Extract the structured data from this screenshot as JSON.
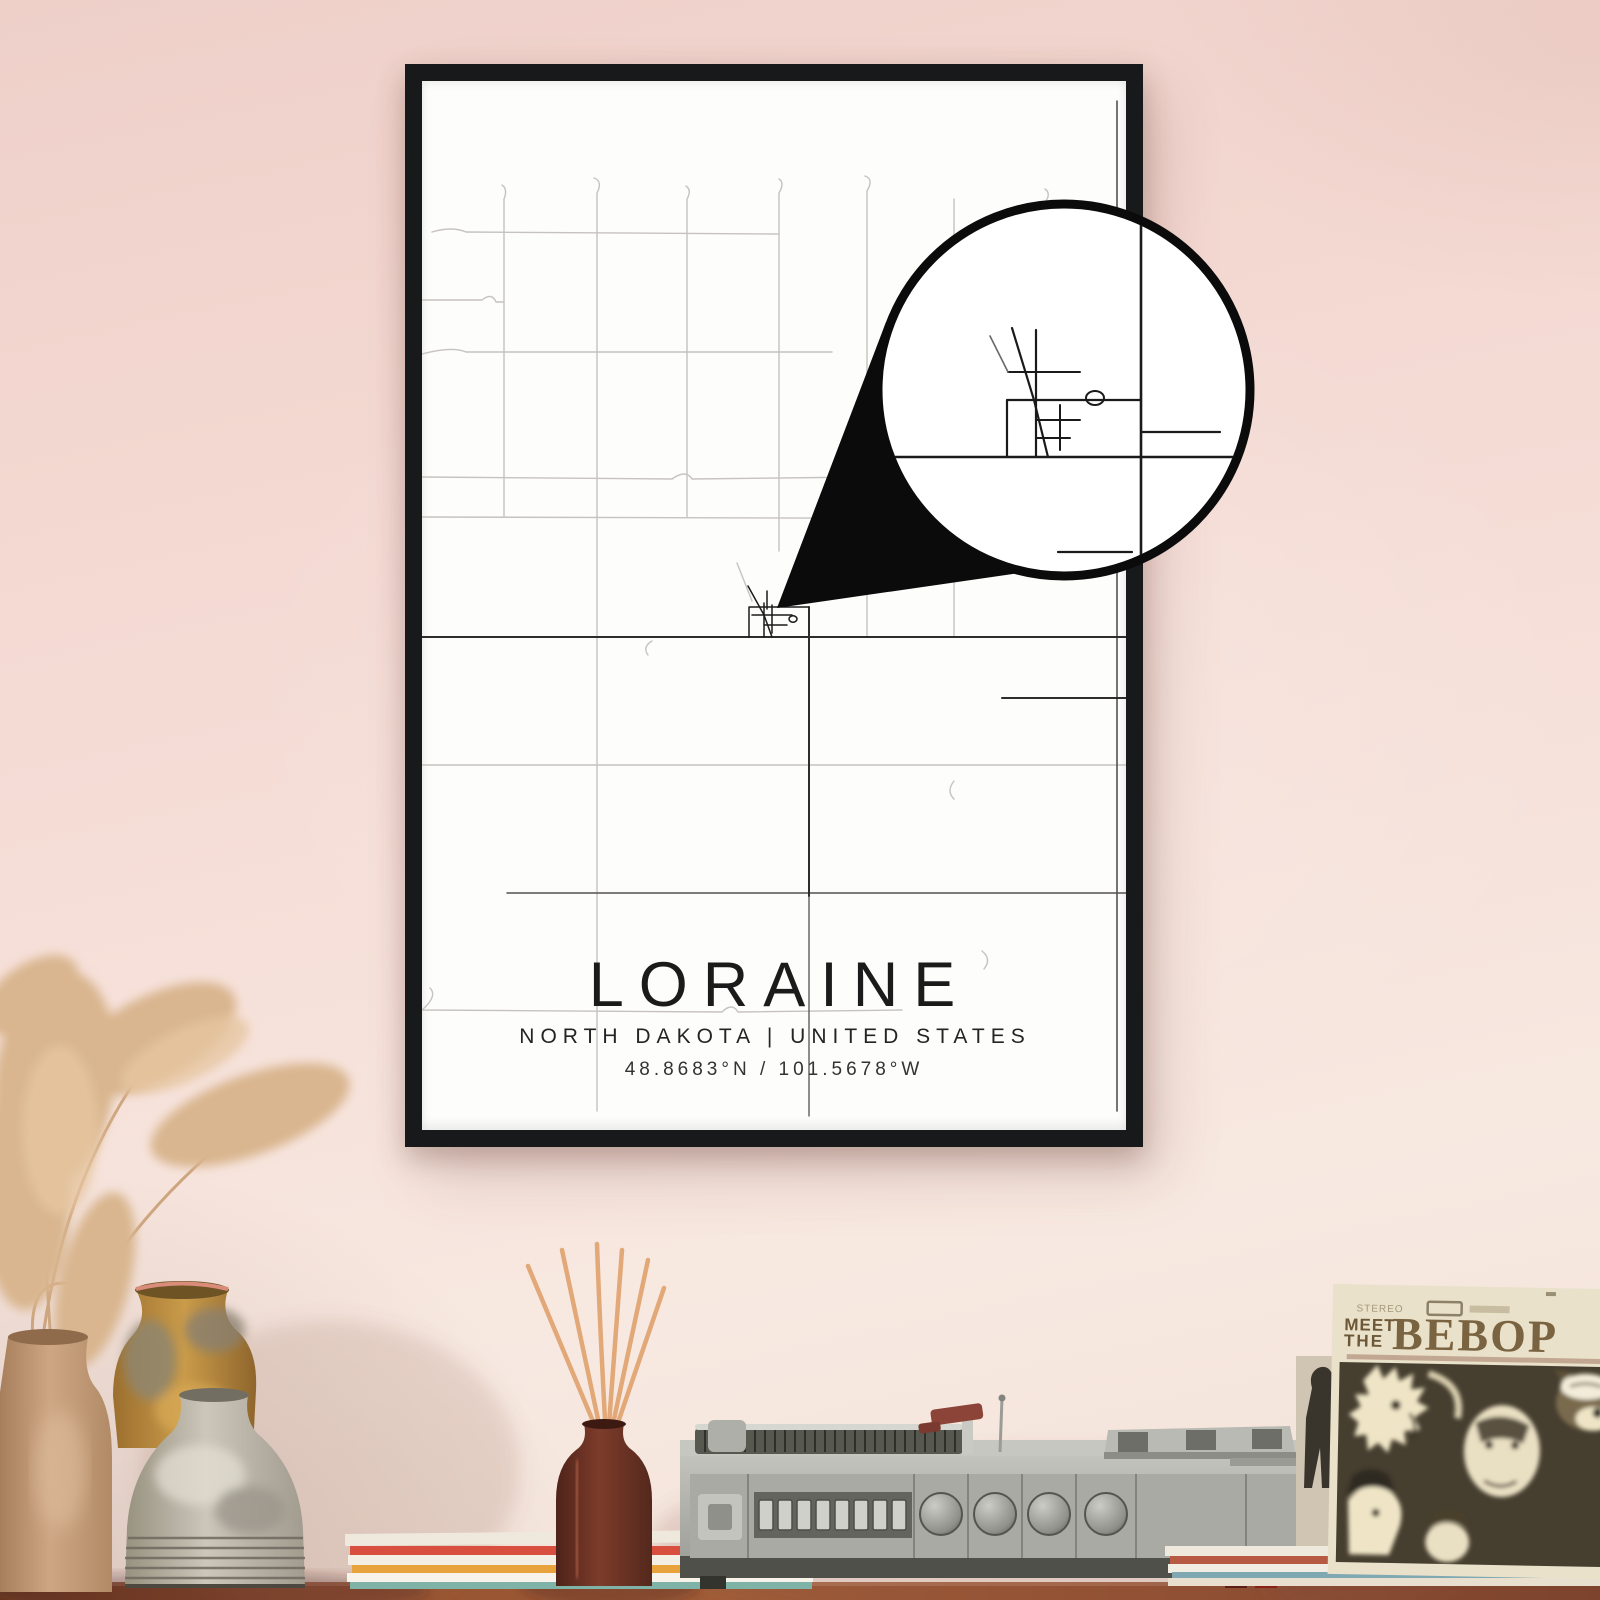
{
  "poster": {
    "title": "LORAINE",
    "region_line": "NORTH DAKOTA | UNITED STATES",
    "coordinates_line": "48.8683°N / 101.5678°W",
    "frame_color": "#17191b",
    "paper_color": "#fdfdfc",
    "road_light_color": "#c6c2bf",
    "road_dark_color": "#2e2d2b",
    "callout_color": "#0b0b0b"
  },
  "album": {
    "header_small_text": "STEREO",
    "title_word1": "MEET",
    "title_word2": "THE",
    "title_word3": "BEBOP",
    "cover_color": "#e9e1ca",
    "title_color": "#6d5737",
    "photo_color": "#463e2f"
  },
  "scene": {
    "wall_color": "#f4dcd5",
    "table_color": "#94512f",
    "vase_tall_color": "#c49b79",
    "vase_amber_color": "#bb8a3f",
    "vase_gray_color": "#b7b1a6",
    "diffuser_bottle_color": "#6b3428",
    "record_player_color": "#b3b4ae"
  }
}
